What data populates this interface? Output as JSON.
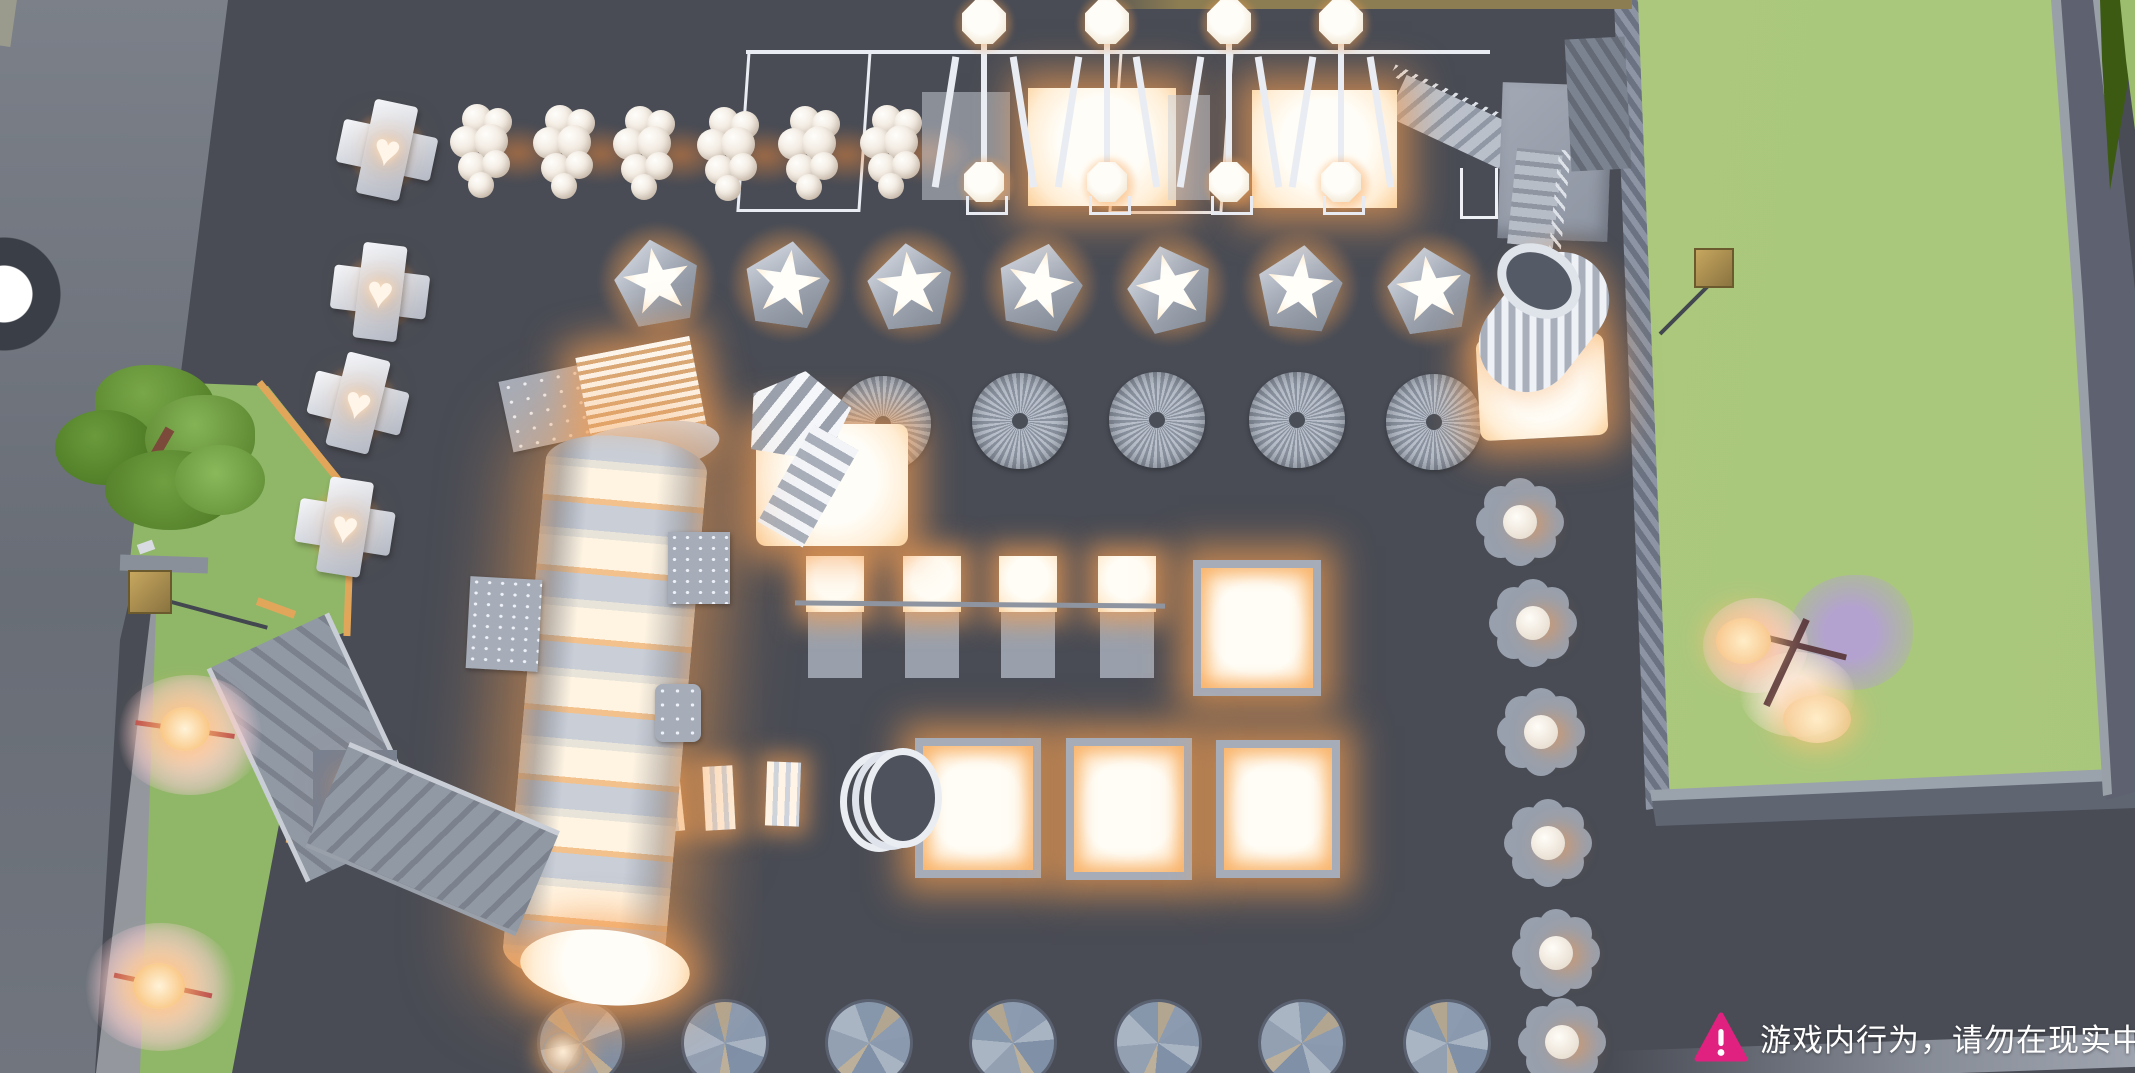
{
  "hud": {
    "locator": {
      "name": "player-location-ping"
    },
    "warning": {
      "icon": "warning-triangle-icon",
      "text": "游戏内行为，请勿在现实中",
      "triangle_color": "#e0217f",
      "text_color": "#ffffff"
    }
  },
  "palette": {
    "plaza": "#494c55",
    "road": "#70757e",
    "sidewalk": "#94989e",
    "grass": "#90b768",
    "field": "#a9c77b",
    "hedge": "#3c5a12",
    "curb": "#e2a65b",
    "structure_light": "#e9edf3",
    "structure_gray": "#9aa1ad",
    "glow_core": "#fff6e9",
    "glow_warm": "#f3a263",
    "lamp_gold": "#b3985c",
    "tree_green": "#5d8a31",
    "tree_pink": "#f4cdd9",
    "tree_purple": "#b3a2cf",
    "disk_blue": "#8494a9",
    "warning_pink": "#e0217f",
    "warn_text": "#ffffff"
  },
  "scene": {
    "objects": {
      "heart_lamp_pedestals": 4,
      "heart_on_stairs": 1,
      "sphere_cluster_lamps": 6,
      "swing_lamp_units": 4,
      "glow_stars": 7,
      "spiro_towers": 5,
      "seesaw_panels": 4,
      "glow_squares": 4,
      "small_glow_blocks": 3,
      "ring_stack": 1,
      "flower_pads": 6,
      "spinner_disks": 7,
      "street_lamps": 2,
      "green_trees": 1,
      "pink_glow_trees": 2,
      "cherry_blossom_trees": 1
    }
  }
}
